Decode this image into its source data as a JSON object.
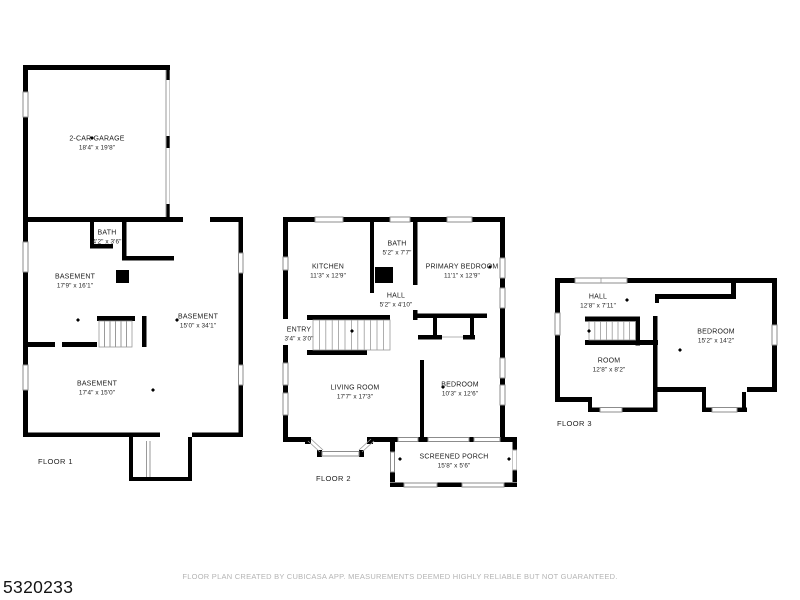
{
  "page": {
    "listing_id": "5320233",
    "disclaimer": "FLOOR PLAN CREATED BY CUBICASA APP. MEASUREMENTS DEEMED HIGHLY RELIABLE BUT NOT GUARANTEED.",
    "background_color": "#ffffff",
    "wall_color": "#000000",
    "window_line_color": "#8c8c8c",
    "muted_text_color": "#b4b4b4"
  },
  "floors": [
    {
      "label": "FLOOR 1",
      "rooms": [
        {
          "name": "2-CAR GARAGE",
          "dims": "18'4\" x 19'8\""
        },
        {
          "name": "BATH",
          "dims": "4'2\" x 3'6\""
        },
        {
          "name": "BASEMENT",
          "dims": "17'9\" x 16'1\""
        },
        {
          "name": "BASEMENT",
          "dims": "15'0\" x 34'1\""
        },
        {
          "name": "BASEMENT",
          "dims": "17'4\" x 15'0\""
        }
      ]
    },
    {
      "label": "FLOOR 2",
      "rooms": [
        {
          "name": "KITCHEN",
          "dims": "11'3\" x 12'9\""
        },
        {
          "name": "BATH",
          "dims": "5'2\" x 7'7\""
        },
        {
          "name": "PRIMARY BEDROOM",
          "dims": "11'1\" x 12'9\""
        },
        {
          "name": "HALL",
          "dims": "5'2\" x 4'10\""
        },
        {
          "name": "ENTRY",
          "dims": "3'4\" x 3'0\""
        },
        {
          "name": "LIVING ROOM",
          "dims": "17'7\" x 17'3\""
        },
        {
          "name": "BEDROOM",
          "dims": "10'3\" x 12'6\""
        },
        {
          "name": "SCREENED PORCH",
          "dims": "15'8\" x 5'6\""
        }
      ]
    },
    {
      "label": "FLOOR 3",
      "rooms": [
        {
          "name": "HALL",
          "dims": "12'8\" x 7'11\""
        },
        {
          "name": "BEDROOM",
          "dims": "15'2\" x 14'2\""
        },
        {
          "name": "ROOM",
          "dims": "12'8\" x 8'2\""
        }
      ]
    }
  ]
}
